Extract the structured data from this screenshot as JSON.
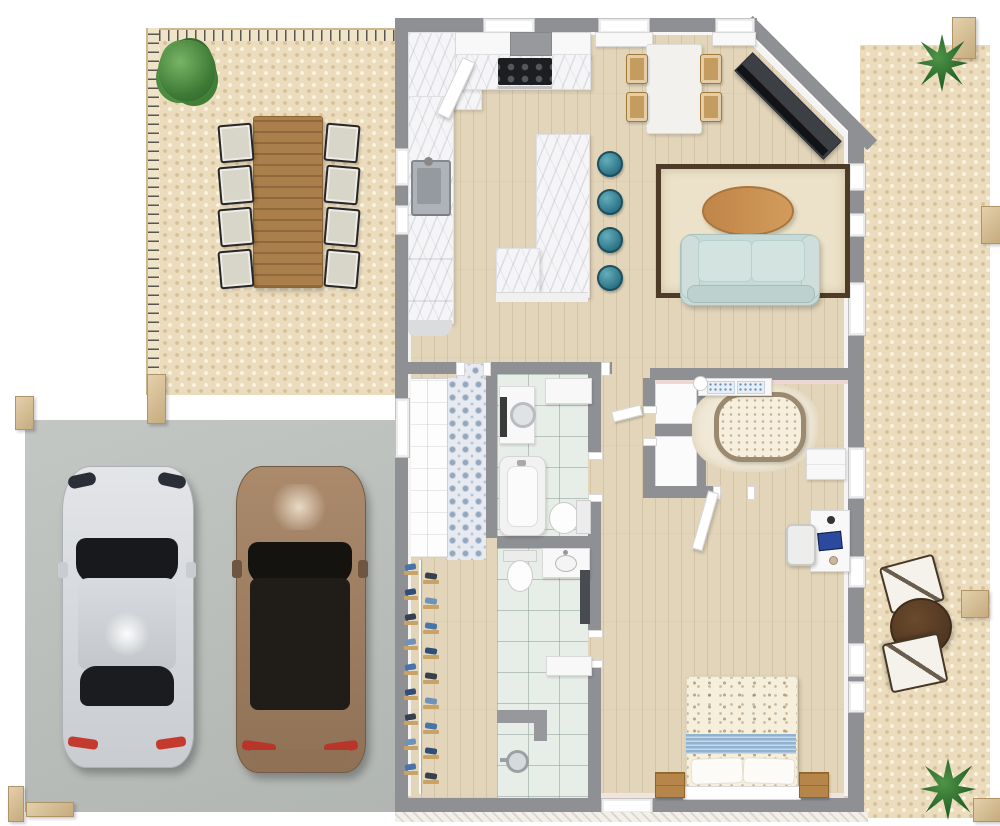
{
  "meta": {
    "kind": "3d-floorplan-top-view",
    "no_visible_text": true
  },
  "palette": {
    "wall": "#8e9094",
    "wood_floor": "#e2d5ba",
    "deck_stone": "#ebdcbd",
    "concrete": "#bcc0bc",
    "bath_tile": "#e7ede7",
    "laundry_tile": "#e7eaf0",
    "marble": "#f5f5f7",
    "sofa": "#c6dad7",
    "stool_teal": "#2e7488",
    "rug": "#ece2c9",
    "rug_border": "#4e3b27",
    "coffee_table": "#c98f50",
    "bed_linen": "#f5efdc",
    "bed_band_blue": "#8fb3d1",
    "nightstand_wood": "#b5854a",
    "crib_rim": "#9c8a70",
    "plant_green": "#3f7c36",
    "car_silver": "#d9dcdf",
    "car_brown": "#a08064",
    "outdoor_table": "#aa7f4c",
    "post_wood": "#d8c29a",
    "tv_console": "#3c3f44"
  },
  "outdoor": {
    "deck": {
      "name": "Deck",
      "railings": [
        "north",
        "west"
      ],
      "plant": "bush",
      "dining_table": "wood plank table",
      "chairs_per_side": 4
    },
    "carport": {
      "name": "Carport",
      "vehicles": [
        {
          "name": "silver-sedan"
        },
        {
          "name": "brown-suv"
        }
      ],
      "posts": 4
    },
    "patio": {
      "name": "Side Patio",
      "furniture": [
        "sling chair",
        "round bistro table",
        "sling chair"
      ],
      "plants": [
        "palm",
        "palm"
      ],
      "posts": 4
    }
  },
  "rooms": {
    "kitchen": {
      "name": "Kitchen",
      "stool_count": 4,
      "features": [
        "corner counter",
        "range hood",
        "cooktop with oven",
        "sink",
        "L-shaped marble island",
        "4 teal bar stools"
      ]
    },
    "dining": {
      "name": "Dining Area",
      "chair_count": 4,
      "features": [
        "white table",
        "4 wood chairs"
      ]
    },
    "living": {
      "name": "Living Room",
      "features": [
        "light-blue sofa",
        "oval wood coffee table",
        "bordered rug",
        "TV console on diagonal wall",
        "patio door"
      ]
    },
    "laundry": {
      "name": "Mudroom",
      "features": [
        "patterned cement tile floor",
        "linen closet"
      ]
    },
    "bath1": {
      "name": "Bathroom 1",
      "features": [
        "washing machine",
        "wall cabinet",
        "bathtub",
        "toilet"
      ]
    },
    "bath2": {
      "name": "Bathroom 2",
      "features": [
        "toilet",
        "vanity sink",
        "dark wall panel",
        "bench",
        "walk-in shower"
      ]
    },
    "hall": {
      "name": "Hallway",
      "shoe_rack_rows": 9,
      "shoe_colors": [
        "#4a74a8",
        "#2f4f78",
        "#37404c",
        "#6f93b8"
      ]
    },
    "nursery": {
      "name": "Nursery Alcove",
      "features": [
        "oval crib",
        "changing table",
        "dresser",
        "two closet nooks",
        "shag rug"
      ]
    },
    "bedroom": {
      "name": "Master Bedroom",
      "features": [
        "double bed with bird-print duvet",
        "blue accent band",
        "2 pillows",
        "2 wood nightstands",
        "desk with laptop and lamp",
        "desk chair"
      ]
    }
  }
}
